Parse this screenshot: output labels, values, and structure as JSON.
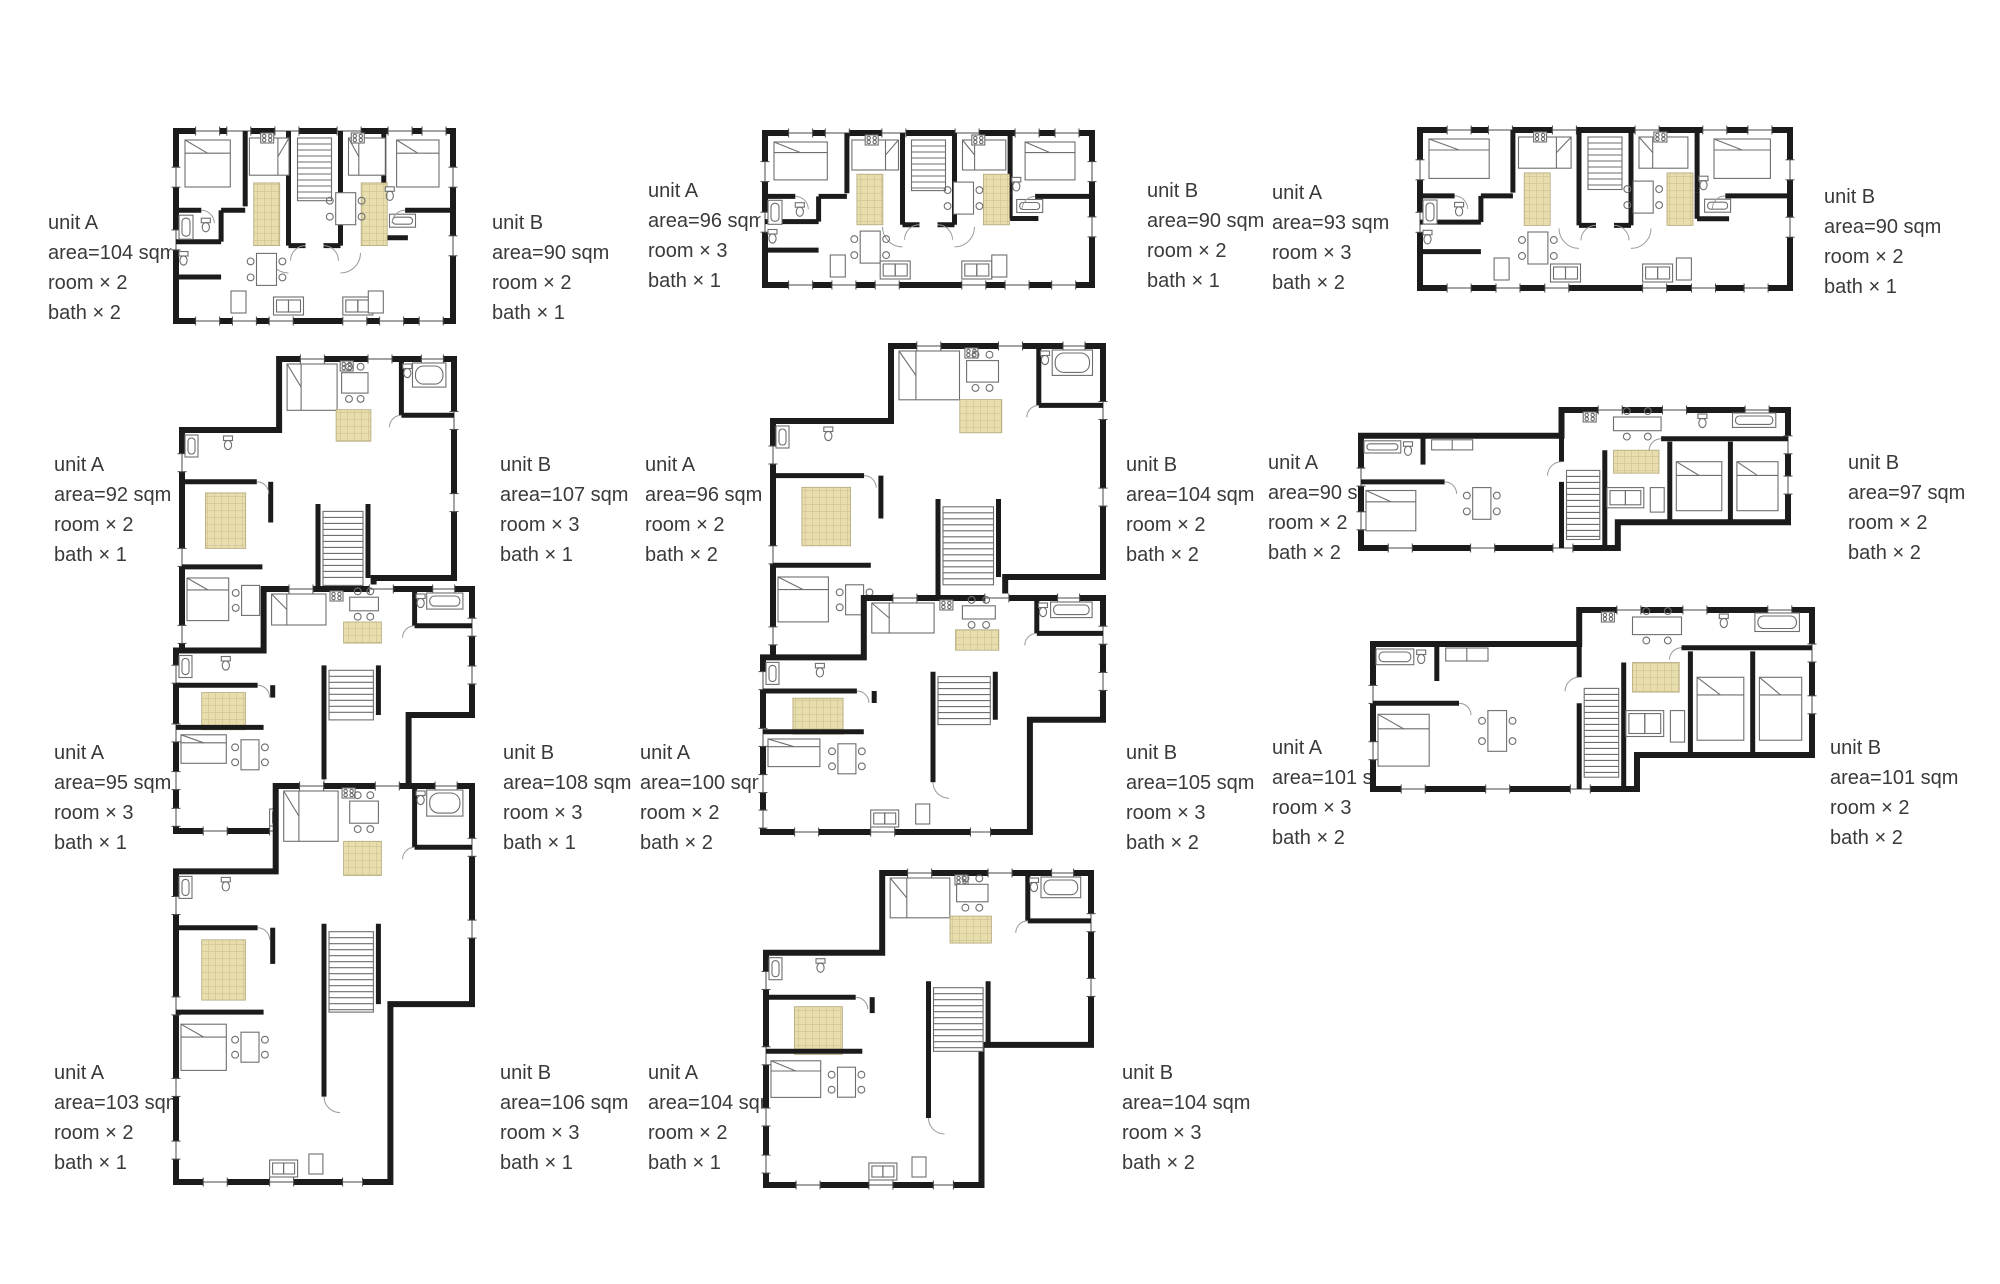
{
  "sheet": {
    "background": "#ffffff",
    "text_color": "#3a3a3a",
    "wall_color": "#1b1b1b",
    "hatch_fill": "#e8ddad",
    "hatch_line": "#c9bc8a"
  },
  "pairs": [
    {
      "unit_a": {
        "title": "unit A",
        "area": "area=104 sqm",
        "rooms": "room × 2",
        "baths": "bath × 2"
      },
      "unit_b": {
        "title": "unit B",
        "area": "area=90 sqm",
        "rooms": "room × 2",
        "baths": "bath × 1"
      }
    },
    {
      "unit_a": {
        "title": "unit A",
        "area": "area=96 sqm",
        "rooms": "room × 3",
        "baths": "bath × 1"
      },
      "unit_b": {
        "title": "unit B",
        "area": "area=90 sqm",
        "rooms": "room × 2",
        "baths": "bath × 1"
      }
    },
    {
      "unit_a": {
        "title": "unit A",
        "area": "area=93 sqm",
        "rooms": "room × 3",
        "baths": "bath × 2"
      },
      "unit_b": {
        "title": "unit B",
        "area": "area=90 sqm",
        "rooms": "room × 2",
        "baths": "bath × 1"
      }
    },
    {
      "unit_a": {
        "title": "unit A",
        "area": "area=92 sqm",
        "rooms": "room × 2",
        "baths": "bath × 1"
      },
      "unit_b": {
        "title": "unit B",
        "area": "area=107 sqm",
        "rooms": "room × 3",
        "baths": "bath × 1"
      }
    },
    {
      "unit_a": {
        "title": "unit A",
        "area": "area=96 sqm",
        "rooms": "room × 2",
        "baths": "bath × 2"
      },
      "unit_b": {
        "title": "unit B",
        "area": "area=104 sqm",
        "rooms": "room × 2",
        "baths": "bath × 2"
      }
    },
    {
      "unit_a": {
        "title": "unit A",
        "area": "area=90 sqm",
        "rooms": "room × 2",
        "baths": "bath × 2"
      },
      "unit_b": {
        "title": "unit B",
        "area": "area=97 sqm",
        "rooms": "room × 2",
        "baths": "bath × 2"
      }
    },
    {
      "unit_a": {
        "title": "unit A",
        "area": "area=95 sqm",
        "rooms": "room × 3",
        "baths": "bath × 1"
      },
      "unit_b": {
        "title": "unit B",
        "area": "area=108 sqm",
        "rooms": "room × 3",
        "baths": "bath × 1"
      }
    },
    {
      "unit_a": {
        "title": "unit A",
        "area": "area=100 sqm",
        "rooms": "room × 2",
        "baths": "bath × 2"
      },
      "unit_b": {
        "title": "unit B",
        "area": "area=105 sqm",
        "rooms": "room × 3",
        "baths": "bath × 2"
      }
    },
    {
      "unit_a": {
        "title": "unit A",
        "area": "area=101 sqm",
        "rooms": "room × 3",
        "baths": "bath × 2"
      },
      "unit_b": {
        "title": "unit B",
        "area": "area=101 sqm",
        "rooms": "room × 2",
        "baths": "bath × 2"
      }
    },
    {
      "unit_a": {
        "title": "unit A",
        "area": "area=103 sqm",
        "rooms": "room × 2",
        "baths": "bath × 1"
      },
      "unit_b": {
        "title": "unit B",
        "area": "area=106 sqm",
        "rooms": "room × 3",
        "baths": "bath × 1"
      }
    },
    {
      "unit_a": {
        "title": "unit A",
        "area": "area=104 sqm",
        "rooms": "room × 2",
        "baths": "bath × 1"
      },
      "unit_b": {
        "title": "unit B",
        "area": "area=104 sqm",
        "rooms": "room × 3",
        "baths": "bath × 2"
      }
    }
  ]
}
